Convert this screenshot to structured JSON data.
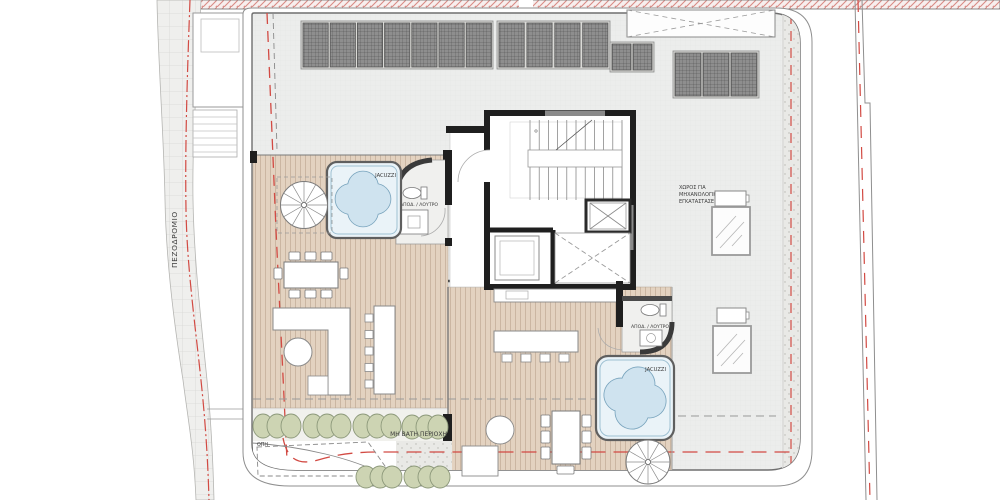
{
  "plan": {
    "labels": {
      "sidewalk": "ΠΕΖΟΔΡΟΜΙΟ",
      "jacuzzi": "JACUZZI",
      "bath": "ΑΠΟΔ. / ΛΟΥΤΡΟ",
      "mech_line1": "ΧΩΡΟΣ ΓΙΑ",
      "mech_line2": "ΜΗΧΑΝΟΛΟΓΙΚΕΣ",
      "mech_line3": "ΕΓΚΑΤΑΣΤΑΣΕΙΣ",
      "non_walkable": "ΜΗ ΒΑΤΗ ΠΕΡΙΟΧΗ",
      "hole": "ΟΠΗ"
    },
    "colors": {
      "boundary_red": "#d24a43",
      "deck_wood": "#e3d2c0",
      "roof_grey": "#ecedec",
      "panel_dark": "#8e8e8e",
      "water_blue": "#d9eaf3",
      "bush_green": "#cdd4b3",
      "wall_black": "#1f1f1f"
    }
  }
}
